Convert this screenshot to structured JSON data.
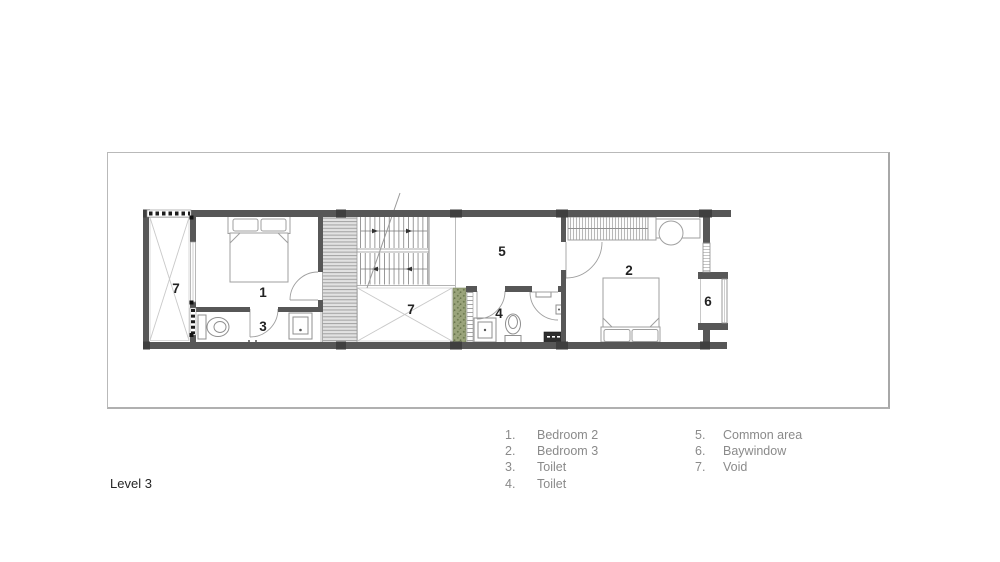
{
  "drawing": {
    "title": "Level 3"
  },
  "plan": {
    "room_labels": [
      {
        "id": "void-left",
        "text": "7"
      },
      {
        "id": "bedroom-2",
        "text": "1"
      },
      {
        "id": "toilet-a",
        "text": "3"
      },
      {
        "id": "void-mid",
        "text": "7"
      },
      {
        "id": "common-area",
        "text": "5"
      },
      {
        "id": "toilet-b",
        "text": "4"
      },
      {
        "id": "bedroom-3",
        "text": "2"
      },
      {
        "id": "baywindow",
        "text": "6"
      }
    ]
  },
  "legend": {
    "columns": [
      {
        "items": [
          {
            "num": "1.",
            "label": "Bedroom 2"
          },
          {
            "num": "2.",
            "label": "Bedroom 3"
          },
          {
            "num": "3.",
            "label": "Toilet"
          },
          {
            "num": "4.",
            "label": "Toilet"
          }
        ]
      },
      {
        "items": [
          {
            "num": "5.",
            "label": "Common area"
          },
          {
            "num": "6.",
            "label": "Baywindow"
          },
          {
            "num": "7.",
            "label": "Void"
          }
        ]
      }
    ]
  },
  "colors": {
    "wall": "#575757",
    "wall_block": "#3f3f3f",
    "furniture_line": "#9f9f9f",
    "void_line": "#c9c9c9",
    "planter_green": "#9aa47b",
    "legend_text": "#8a8a8a",
    "label_text": "#222222"
  }
}
